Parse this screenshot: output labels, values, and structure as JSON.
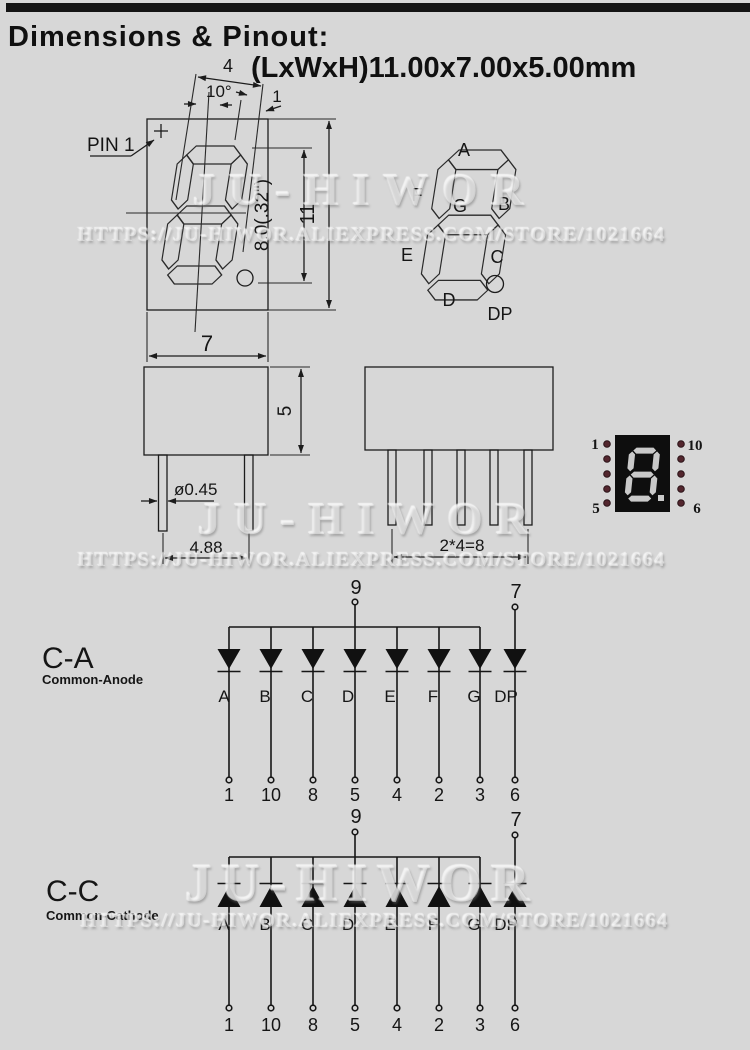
{
  "page": {
    "background": "#d7d7d7",
    "top_bar_color": "#141414",
    "line_color": "#1c1c1c"
  },
  "header": {
    "title": "Dimensions & Pinout:",
    "subtitle": "(LxWxH)11.00x7.00x5.00mm"
  },
  "watermark": {
    "brand": "JU-HIWOR",
    "url": "HTTPS://JU-HIWOR.ALIEXPRESS.COM/STORE/1021664"
  },
  "front_view": {
    "pin1_label": "PIN 1",
    "dim_top": "4",
    "dim_angle": "10°",
    "dim_seg": "1",
    "dim_digit_height": "8.0(.32\")",
    "dim_total_height": "11",
    "dim_width": "7"
  },
  "segment_map": {
    "a": "A",
    "b": "B",
    "c": "C",
    "d": "D",
    "e": "E",
    "f": "F",
    "g": "G",
    "dp": "DP"
  },
  "side_view_front": {
    "dim_body_height": "5",
    "dim_pin_diameter": "ø0.45",
    "dim_pin_pitch": "4.88"
  },
  "side_view_side": {
    "dim_pin_span": "2*4=8"
  },
  "display_module": {
    "pin_top_left": "1",
    "pin_top_right": "10",
    "pin_bottom_left": "5",
    "pin_bottom_right": "6",
    "body_color": "#0e0e0e",
    "segment_color": "#c9c9c9",
    "dot_color": "#53262e"
  },
  "common_anode": {
    "title": "C-A",
    "subtitle": "Common-Anode",
    "common_pin": "9",
    "dp_pin": "7",
    "segments": [
      "A",
      "B",
      "C",
      "D",
      "E",
      "F",
      "G",
      "DP"
    ],
    "pins": [
      "1",
      "10",
      "8",
      "5",
      "4",
      "2",
      "3",
      "6"
    ]
  },
  "common_cathode": {
    "title": "C-C",
    "subtitle": "Common-Cathode",
    "common_pin": "9",
    "dp_pin": "7",
    "segments": [
      "A",
      "B",
      "C",
      "D",
      "E",
      "F",
      "G",
      "DP"
    ],
    "pins": [
      "1",
      "10",
      "8",
      "5",
      "4",
      "2",
      "3",
      "6"
    ]
  }
}
